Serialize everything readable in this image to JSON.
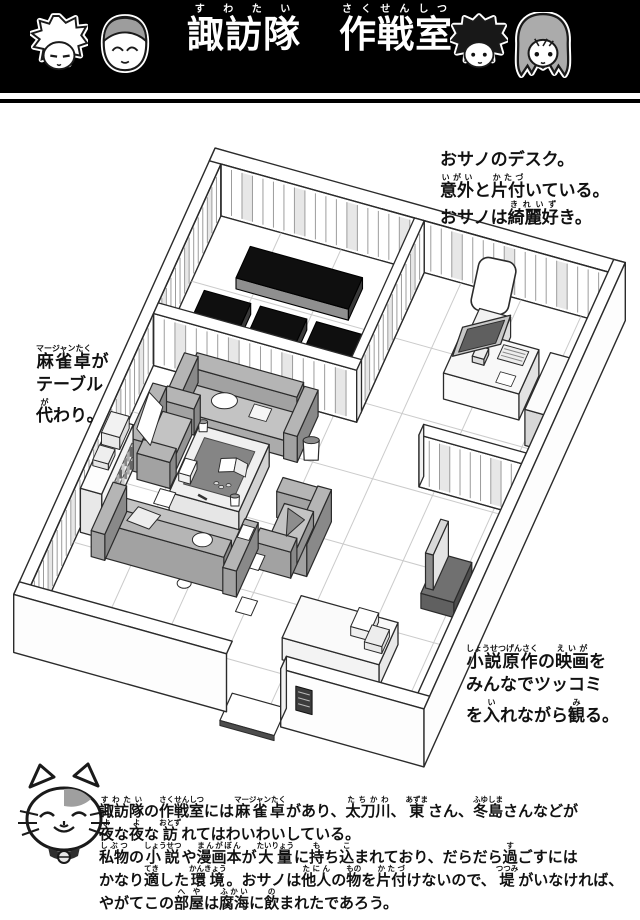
{
  "colors": {
    "banner_bg": "#000000",
    "paper": "#ffffff",
    "ink": "#111111",
    "futon": "#0f0f0f",
    "sofa_gray": "#b5b5b5"
  },
  "header": {
    "title": [
      {
        "base": "諏訪隊",
        "ruby": "すわたい"
      },
      {
        "base": "　"
      },
      {
        "base": "作戦室",
        "ruby": "さくせんしつ"
      }
    ]
  },
  "annotations": {
    "desk": {
      "lines": [
        [
          {
            "base": "おサノのデスク。"
          }
        ],
        [
          {
            "base": "意外",
            "ruby": "いがい"
          },
          {
            "base": "と"
          },
          {
            "base": "片付",
            "ruby": "かたづ"
          },
          {
            "base": "いている。"
          }
        ],
        [
          {
            "base": "おサノは"
          },
          {
            "base": "綺麗好",
            "ruby": "きれいず"
          },
          {
            "base": "き。"
          }
        ]
      ]
    },
    "mahjong": {
      "lines": [
        [
          {
            "base": "麻雀卓",
            "ruby": "マージャンたく"
          },
          {
            "base": "が"
          }
        ],
        [
          {
            "base": "テーブル"
          }
        ],
        [
          {
            "base": "代",
            "ruby": "が"
          },
          {
            "base": "わり。"
          }
        ]
      ]
    },
    "movie": {
      "lines": [
        [
          {
            "base": "小説原作",
            "ruby": "しょうせつげんさく"
          },
          {
            "base": "の"
          },
          {
            "base": "映画",
            "ruby": "えいが"
          },
          {
            "base": "を"
          }
        ],
        [
          {
            "base": "みんなでツッコミ"
          }
        ],
        [
          {
            "base": "を"
          },
          {
            "base": "入",
            "ruby": "い"
          },
          {
            "base": "れながら"
          },
          {
            "base": "観",
            "ruby": "み"
          },
          {
            "base": "る。"
          }
        ]
      ]
    }
  },
  "footer": {
    "lines": [
      [
        {
          "base": "諏訪隊",
          "ruby": "すわたい"
        },
        {
          "base": "の"
        },
        {
          "base": "作戦室",
          "ruby": "さくせんしつ"
        },
        {
          "base": "には"
        },
        {
          "base": "麻雀卓",
          "ruby": "マージャンたく"
        },
        {
          "base": "があり、"
        },
        {
          "base": "太刀川",
          "ruby": "たちかわ"
        },
        {
          "base": "、"
        },
        {
          "base": "東",
          "ruby": "あずま"
        },
        {
          "base": "さん、"
        },
        {
          "base": "冬島",
          "ruby": "ふゆしま"
        },
        {
          "base": "さんなどが"
        }
      ],
      [
        {
          "base": "夜",
          "ruby": "よ"
        },
        {
          "base": "な"
        },
        {
          "base": "夜",
          "ruby": "よ"
        },
        {
          "base": "な"
        },
        {
          "base": "訪",
          "ruby": "おとず"
        },
        {
          "base": "れてはわいわいしている。"
        }
      ],
      [
        {
          "base": "私物",
          "ruby": "しぶつ"
        },
        {
          "base": "の"
        },
        {
          "base": "小説",
          "ruby": "しょうせつ"
        },
        {
          "base": "や"
        },
        {
          "base": "漫画本",
          "ruby": "まんがぼん"
        },
        {
          "base": "が"
        },
        {
          "base": "大量",
          "ruby": "たいりょう"
        },
        {
          "base": "に"
        },
        {
          "base": "持",
          "ruby": "も"
        },
        {
          "base": "ち"
        },
        {
          "base": "込",
          "ruby": "こ"
        },
        {
          "base": "まれており、だらだら"
        },
        {
          "base": "過",
          "ruby": "す"
        },
        {
          "base": "ごすには"
        }
      ],
      [
        {
          "base": "かなり"
        },
        {
          "base": "適",
          "ruby": "てき"
        },
        {
          "base": "した"
        },
        {
          "base": "環境",
          "ruby": "かんきょう"
        },
        {
          "base": "。おサノは"
        },
        {
          "base": "他人",
          "ruby": "たにん"
        },
        {
          "base": "の"
        },
        {
          "base": "物",
          "ruby": "もの"
        },
        {
          "base": "を"
        },
        {
          "base": "片付",
          "ruby": "かたづ"
        },
        {
          "base": "けないので、"
        },
        {
          "base": "堤",
          "ruby": "つつみ"
        },
        {
          "base": "がいなければ、"
        }
      ],
      [
        {
          "base": "やがてこの"
        },
        {
          "base": "部屋",
          "ruby": "へや"
        },
        {
          "base": "は"
        },
        {
          "base": "腐海",
          "ruby": "ふかい"
        },
        {
          "base": "に"
        },
        {
          "base": "飲",
          "ruby": "の"
        },
        {
          "base": "まれたであろう。"
        }
      ]
    ]
  }
}
